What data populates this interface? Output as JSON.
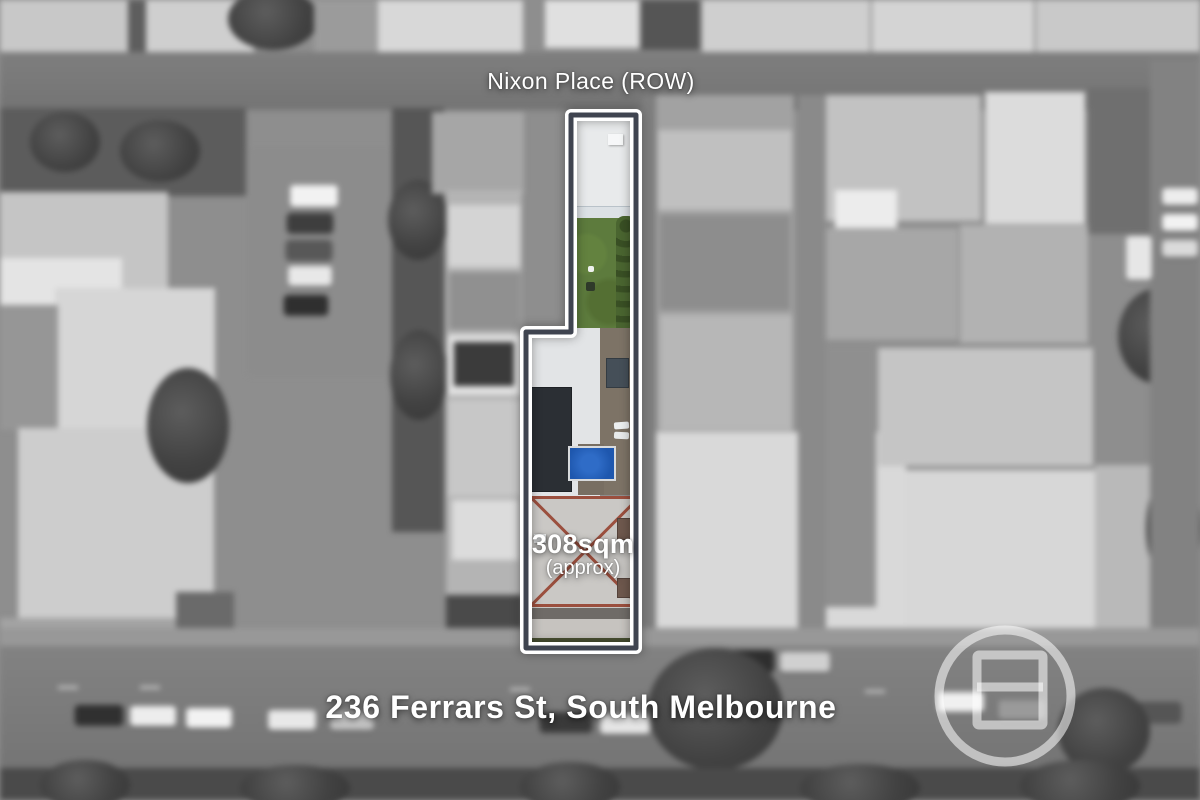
{
  "image_type": "real-estate aerial photograph with highlighted lot",
  "labels": {
    "laneway": "Nixon Place (ROW)",
    "area_value": "308sqm",
    "area_qualifier": "(approx)",
    "address": "236 Ferrars St, South Melbourne"
  },
  "property": {
    "boundary_outline_color": "#ffffff",
    "boundary_inner_line_color": "#3f4450",
    "lawn_color": "#5d7b3d",
    "hedge_color": "#42592a",
    "pool_color": "#1e57ae",
    "solar_panel_color": "#2b2f34",
    "main_roof_ridge_color": "#9b4f3e"
  },
  "watermark": {
    "icon": "agency-logo-circle-icon",
    "color": "rgba(255,255,255,0.55)"
  }
}
